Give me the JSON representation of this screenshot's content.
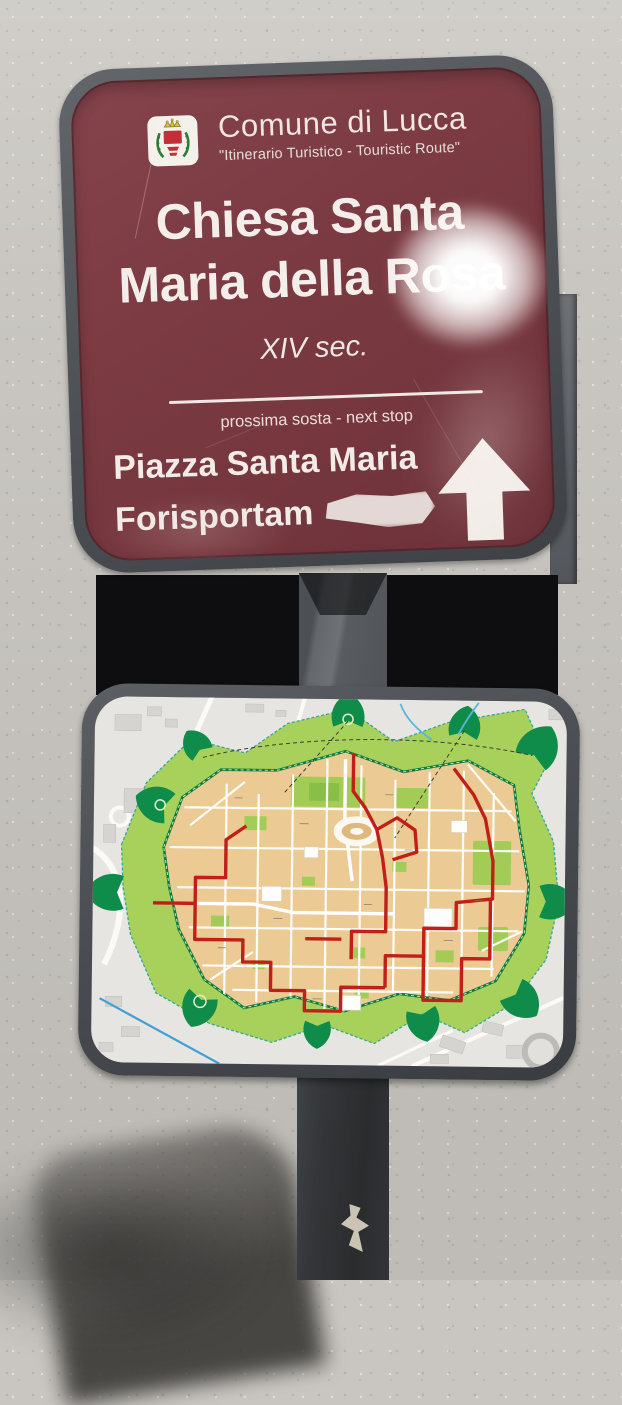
{
  "photo": {
    "wall_color": "#c9c6c1",
    "pole_color": "#5d6064",
    "pole_shadow_color": "#2d2f32"
  },
  "top_sign": {
    "frame_color": "#53565a",
    "panel_color": "#7b3a42",
    "text_color": "#f2ebe7",
    "crest_icon": "lucca-coat-of-arms",
    "header_title": "Comune di Lucca",
    "header_subtitle": "\"Itinerario Turistico - Touristic Route\"",
    "title_line1": "Chiesa Santa",
    "title_line2": "Maria della Rosa",
    "period": "XIV sec.",
    "next_stop_label": "prossima sosta - next stop",
    "destination_line1": "Piazza Santa Maria",
    "destination_line2": "Forisportam",
    "direction_icon": "arrow-up-icon"
  },
  "map_sign": {
    "frame_color": "#46494d",
    "subject": "lucca-walled-city-street-map",
    "colors": {
      "city_fill": "#ebcb93",
      "glacis_green": "#a8d15c",
      "bastion_green": "#0f8c49",
      "route_red": "#c02019",
      "outside_fill": "#e7e5e1",
      "water_blue": "#58b6df"
    }
  }
}
